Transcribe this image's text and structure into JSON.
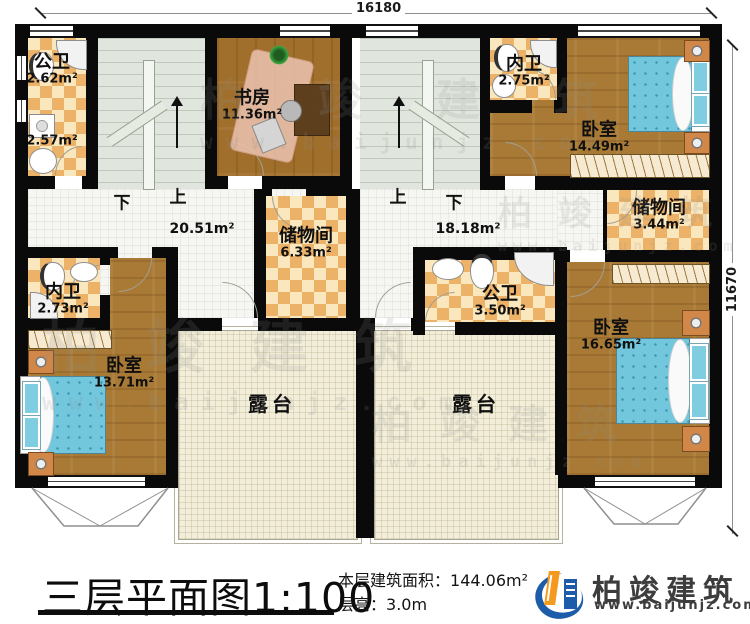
{
  "dimensions": {
    "width_top": "16180",
    "height_right": "11670"
  },
  "watermark": {
    "brand": "柏竣建筑",
    "site": "www.baijunjz.com"
  },
  "stairs": {
    "left_down": "下",
    "left_up": "上",
    "right_up": "上",
    "right_down": "下"
  },
  "rooms": {
    "bath_top_left": {
      "name": "公卫",
      "area": "2.62m²",
      "area2": "2.57m²"
    },
    "study": {
      "name": "书房",
      "area": "11.36m²"
    },
    "inner_bath_top_right": {
      "name": "内卫",
      "area": "2.75m²"
    },
    "bedroom_top_right": {
      "name": "卧室",
      "area": "14.49m²"
    },
    "hall_left": {
      "area": "20.51m²"
    },
    "hall_right": {
      "area": "18.18m²"
    },
    "storage_left": {
      "name": "储物间",
      "area": "6.33m²"
    },
    "storage_right": {
      "name": "储物间",
      "area": "3.44m²"
    },
    "inner_bath_bottom_left": {
      "name": "内卫",
      "area": "2.73m²"
    },
    "bath_right": {
      "name": "公卫",
      "area": "3.50m²"
    },
    "bedroom_bottom_left": {
      "name": "卧室",
      "area": "13.71m²"
    },
    "bedroom_bottom_right": {
      "name": "卧室",
      "area": "16.65m²"
    },
    "terrace_left": {
      "name": "露台"
    },
    "terrace_right": {
      "name": "露台"
    }
  },
  "footer": {
    "title": "三层平面图",
    "scale": "1:100",
    "area_label": "本层建筑面积：",
    "area_value": "144.06m²",
    "floor_height_label": "层高：",
    "floor_height_value": "3.0m",
    "brand": "柏竣建筑",
    "site": "www.baijunjz.com"
  },
  "colors": {
    "wall": "#0a0a0a",
    "wood": "#a97a35",
    "tile_light": "#fbe7bd",
    "tile_dark": "#ecb268",
    "bed_blue": "#72c7dd",
    "logo_blue": "#1c5ca8",
    "logo_orange": "#f49a1f"
  }
}
